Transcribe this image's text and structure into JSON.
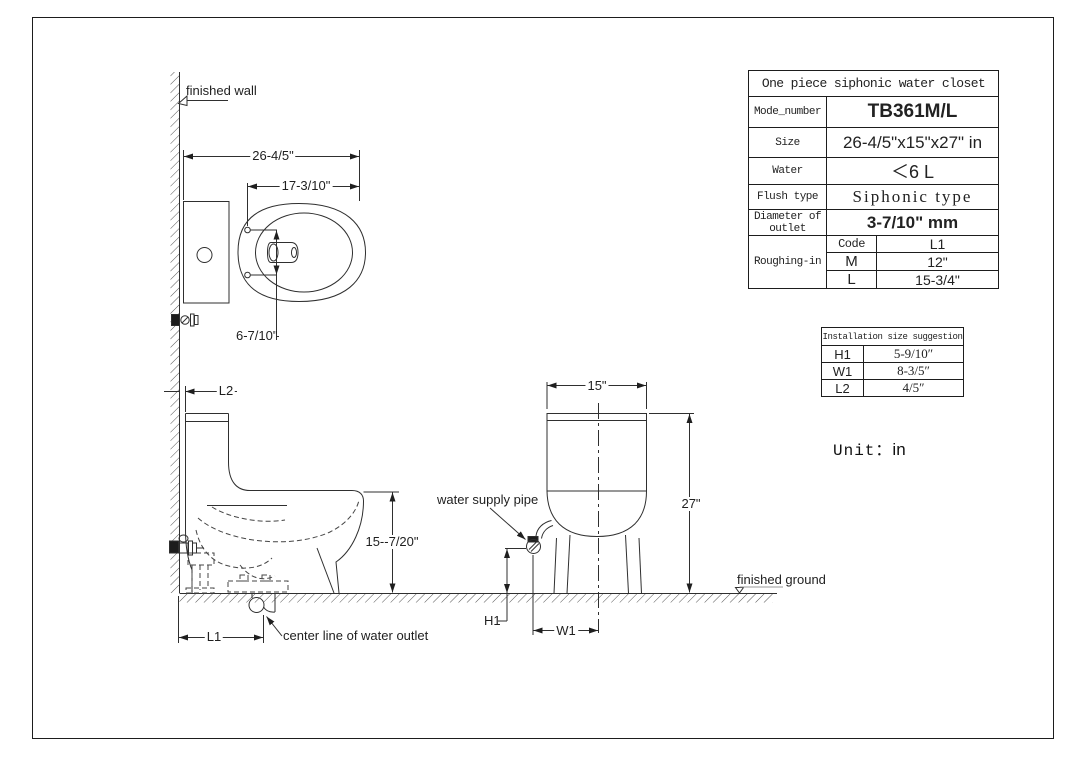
{
  "labels": {
    "finished_wall": "finished wall",
    "finished_ground": "finished ground",
    "water_supply_pipe": "water supply pipe",
    "center_line_of_water_outlet": "center line of water outlet",
    "unit_label": "Unit：",
    "unit_value": "in"
  },
  "dimensions": {
    "plan_overall_depth": "26-4/5\"",
    "plan_bowl_length": "17-3/10\"",
    "plan_hinge_spacing": "6-7/10\"",
    "side_wall_gap": "L2",
    "side_seat_height": "15--7/20\"",
    "side_outlet_offset": "L1",
    "front_tank_width": "15\"",
    "front_total_height": "27\"",
    "front_supply_height": "H1",
    "front_supply_offset": "W1"
  },
  "spec_table": {
    "title": "One piece siphonic water closet",
    "rows": [
      {
        "label": "Mode_number",
        "value": "TB361M/L"
      },
      {
        "label": "Size",
        "value": "26-4/5\"x15\"x27\" in"
      },
      {
        "label": "Water",
        "value": "＜6 L"
      },
      {
        "label": "Flush type",
        "value": "Siphonic type"
      },
      {
        "label": "Diameter of outlet",
        "value": "3-7/10\" mm"
      }
    ],
    "roughing_in": {
      "label": "Roughing-in",
      "col_headers": [
        "Code",
        "L1"
      ],
      "rows": [
        [
          "M",
          "12\""
        ],
        [
          "L",
          "15-3/4\""
        ]
      ]
    }
  },
  "installation_table": {
    "title": "Installation size suggestion",
    "rows": [
      {
        "label": "H1",
        "value": "5-9/10″"
      },
      {
        "label": "W1",
        "value": "8-3/5″"
      },
      {
        "label": "L2",
        "value": "4/5″"
      }
    ]
  },
  "colors": {
    "line": "#2f2f2f",
    "background": "#ffffff"
  }
}
